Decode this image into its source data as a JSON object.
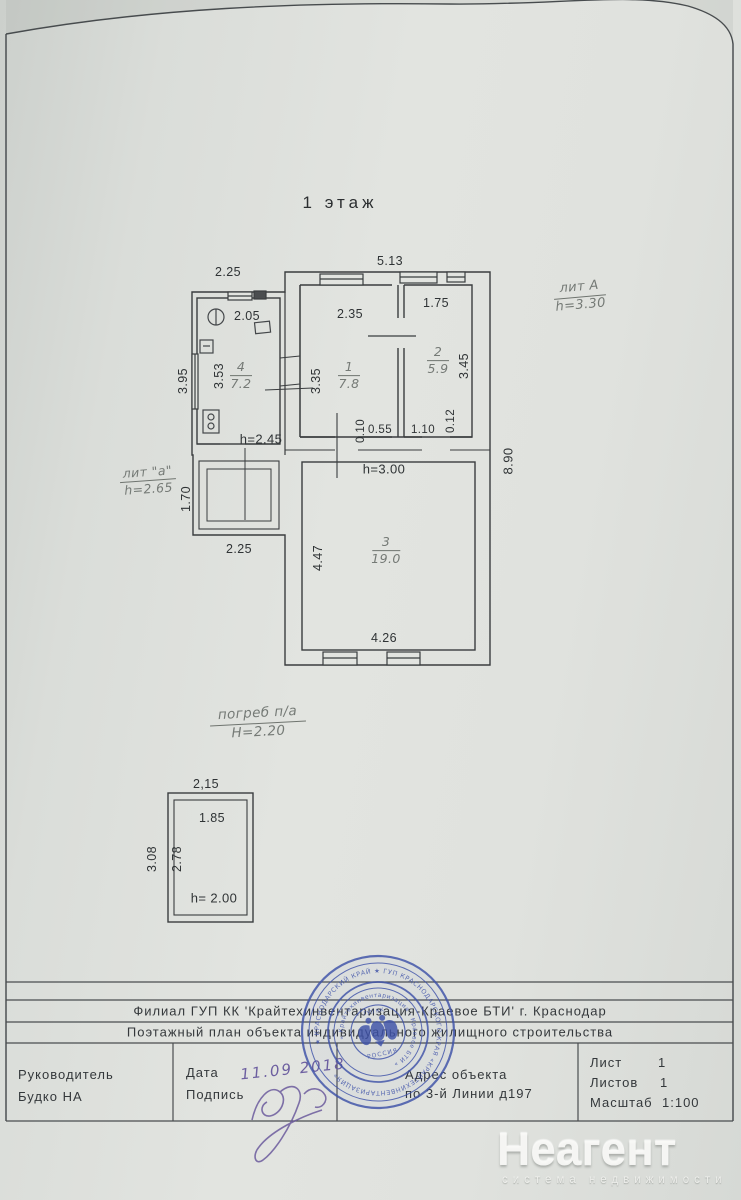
{
  "page": {
    "floor_title": "1 этаж"
  },
  "plan": {
    "liters": {
      "a": {
        "name": "лит А",
        "h": "h=3.30"
      },
      "a_small": {
        "name": "лит \"а\"",
        "h": "h=2.65"
      },
      "cellar": {
        "name": "погреб п/а",
        "h": "H=2.20"
      }
    },
    "rooms": [
      {
        "num": "4",
        "area": "7.2"
      },
      {
        "num": "1",
        "area": "7.8"
      },
      {
        "num": "2",
        "area": "5.9"
      },
      {
        "num": "3",
        "area": "19.0"
      }
    ],
    "dims": {
      "top_left": "2.25",
      "top_right": "5.13",
      "kitchen_w": "2.05",
      "room1_w": "2.35",
      "room2_w": "1.75",
      "left_out": "3.95",
      "kitchen_h": "3.53",
      "room1_h": "3.35",
      "room2_h": "3.45",
      "gap_010": "0.10",
      "gap_055": "0.55",
      "gap_110": "1.10",
      "gap_012": "0.12",
      "h_kitchen": "h=2.45",
      "h_room3": "h=3.00",
      "right_out": "8.90",
      "porch_h": "1.70",
      "porch_w": "2.25",
      "room3_h": "4.47",
      "room3_w": "4.26"
    }
  },
  "cellar_plan": {
    "dims": {
      "w_out": "2,15",
      "w_in": "1.85",
      "h_out": "3.08",
      "h_in": "2.78",
      "h_room": "h= 2.00"
    }
  },
  "title_block": {
    "org_line": "Филиал ГУП КК 'Крайтехинвентаризация-Краевое БТИ'   г. Краснодар",
    "doc_line": "Поэтажный план объекта индивидуального жилищного строительства",
    "head_label": "Руководитель",
    "head_name": "Будко НА",
    "date_label": "Дата",
    "date_value": "11.09 2018",
    "sign_label": "Подпись",
    "addr_label": "Адрес объекта",
    "addr_value": "по 3-й Линии  д197",
    "sheet_label": "Лист",
    "sheet_value": "1",
    "sheets_label": "Листов",
    "sheets_value": "1",
    "scale_label": "Масштаб",
    "scale_value": "1:100"
  },
  "stamp": {
    "ring_outer": "★ КРАСНОДАРСКИЙ КРАЙ ★ ГУП КРАСНОДАРСКОГО КРАЯ «КРАЙТЕХИНВЕНТАРИЗАЦИЯ»",
    "ring_inner": "« Крайтехинвентаризация - Краевое БТИ »",
    "center_top": "ГУП КК",
    "center_bottom": "РОССИЯ",
    "color": "#3d51a8"
  },
  "watermark": {
    "name": "Неагент",
    "tagline": "система недвижимости"
  }
}
